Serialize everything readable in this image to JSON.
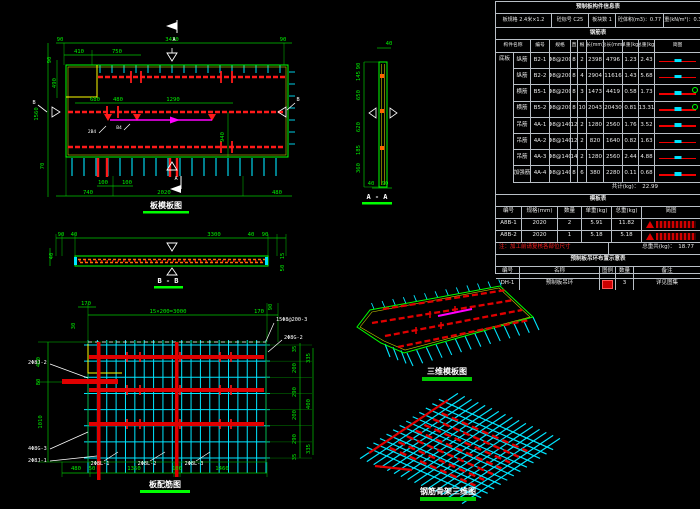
{
  "colors": {
    "background": "#000000",
    "green": "#00ff00",
    "red": "#ff0000",
    "cyan": "#00ffff",
    "magenta": "#ff00ff",
    "yellow": "#ffff00",
    "white": "#ffffff",
    "orange": "#ff8000",
    "table_border": "#b9bfc6"
  },
  "formwork_plan": {
    "title": "板模板图",
    "dims": {
      "top": [
        "90",
        "3430",
        "90"
      ],
      "mid": [
        "410",
        "750"
      ],
      "left": [
        "90",
        "490",
        "1560",
        "70"
      ],
      "inner": [
        "680",
        "480",
        "1290",
        "940"
      ],
      "bottom": [
        "100",
        "100",
        "740",
        "2020",
        "480"
      ]
    },
    "marks": {
      "a": "A",
      "b": "B"
    },
    "tags": [
      "2B4",
      "B4"
    ]
  },
  "section_aa": {
    "title": "A - A",
    "top": "40",
    "left": [
      "90",
      "145",
      "650",
      "620",
      "185",
      "360"
    ],
    "bottom": [
      "40",
      "90"
    ]
  },
  "section_bb": {
    "title": "B - B",
    "top": [
      "90",
      "40",
      "3300",
      "40",
      "90"
    ],
    "left": "40",
    "right": [
      "15",
      "50"
    ]
  },
  "rebar_plan": {
    "title": "板配筋图",
    "top": [
      "170",
      "15×200=3000",
      "170"
    ],
    "top_rot": [
      "30",
      "90"
    ],
    "left": [
      "400",
      "80",
      "1010"
    ],
    "right_inner": [
      "35",
      "200",
      "290",
      "200",
      "290",
      "35"
    ],
    "right_outer": [
      "335",
      "400",
      "335"
    ],
    "bottom": [
      "480",
      "50",
      "1350",
      "100",
      "1460"
    ],
    "leaders": {
      "r1": "15Φ8@200-3",
      "r2": "2Φ8G-2",
      "l1": "2Φ8J-2",
      "l2": "4Φ8G-3",
      "l3": "2Φ8J-1",
      "b1": "2Φ8L-1",
      "b2": "2Φ8L-2",
      "b3": "2Φ8L-3"
    }
  },
  "iso_views": {
    "formwork_title": "三维模板图",
    "cage_title": "钢筋骨架三维图"
  },
  "tables": {
    "info": {
      "title": "预制板构件信息表",
      "params": [
        "板规格 2.4米×1.2",
        "砼标号 C25",
        "板块数 1",
        "砼体积(m3)：0.77",
        "板重(kN/m²)：0.31"
      ]
    },
    "rebar": {
      "band": "钢筋表",
      "headers": [
        "构件名称",
        "编号",
        "规格",
        "直",
        "根",
        "长(mm)",
        "总长(mm)",
        "单重(kg)",
        "总重(kg)",
        "简图"
      ],
      "group": "底板",
      "rows": [
        [
          "纵筋",
          "B2-1",
          "Φ8@200",
          "8",
          "2",
          "2398",
          "4796",
          "1.23",
          "2.43"
        ],
        [
          "纵筋",
          "B2-2",
          "Φ8@200",
          "8",
          "4",
          "2904",
          "11616",
          "1.43",
          "5.68"
        ],
        [
          "横筋",
          "B5-1",
          "Φ8@200",
          "8",
          "3",
          "1473",
          "4419",
          "0.58",
          "1.73"
        ],
        [
          "横筋",
          "B5-2",
          "Φ8@200",
          "8",
          "10",
          "2043",
          "20430",
          "0.81",
          "13.31"
        ],
        [
          "吊筋",
          "4A-1",
          "Φ8@140",
          "12",
          "2",
          "1280",
          "2560",
          "1.76",
          "3.52"
        ],
        [
          "吊筋",
          "4A-2",
          "Φ8@140",
          "12",
          "2",
          "820",
          "1640",
          "0.82",
          "1.63"
        ],
        [
          "吊筋",
          "4A-3",
          "Φ8@140",
          "14",
          "2",
          "1280",
          "2560",
          "2.44",
          "4.88"
        ],
        [
          "加强筋",
          "4A-4",
          "Φ8@140",
          "8",
          "6",
          "380",
          "2280",
          "0.11",
          "0.68"
        ]
      ],
      "total_label": "共计(kg)：",
      "total_value": "22.99"
    },
    "formwork": {
      "band": "模板表",
      "headers": [
        "编号",
        "规格(mm)",
        "数量",
        "单重(kg)",
        "总重(kg)",
        "简图"
      ],
      "rows": [
        [
          "A8B-1",
          "2020",
          "2",
          "5.91",
          "11.82"
        ],
        [
          "A8B-2",
          "2020",
          "1",
          "5.18",
          "5.18"
        ]
      ],
      "note": "注：加工前请复核各部位尺寸",
      "total_label": "总重共(kg)：",
      "total_value": "18.77"
    },
    "hooks": {
      "band": "预制板吊环布置示意表",
      "headers": [
        "编号",
        "名称",
        "图例",
        "数量",
        "备注"
      ],
      "row": [
        "DH-1",
        "预制板吊环",
        "3",
        "详见图集"
      ]
    }
  }
}
